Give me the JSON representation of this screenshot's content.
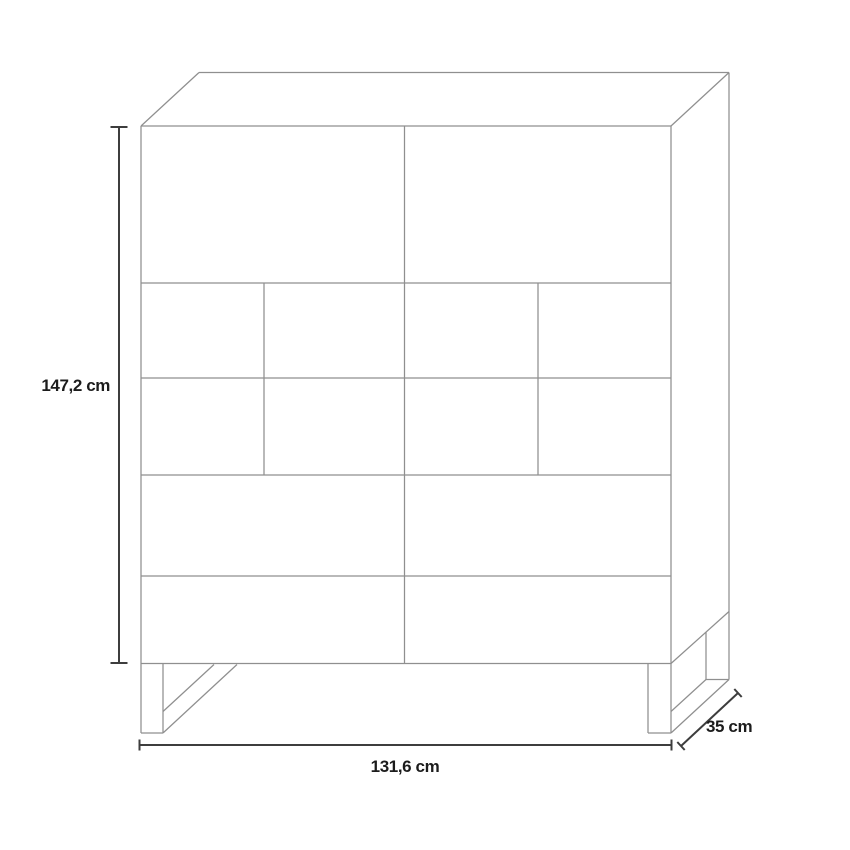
{
  "page": {
    "background": "#ffffff",
    "description": "Product dimension diagram of a tall sideboard cabinet drawn in 3D outline"
  },
  "diagram": {
    "type": "furniture-dimension-diagram",
    "unit": "cm",
    "colors": {
      "structure_stroke": "#8f8f8f",
      "dimension_stroke": "#3d3d3d",
      "label_color": "#1c1c1c"
    },
    "dimensions": {
      "height": {
        "value": 147.2,
        "label": "147,2 cm"
      },
      "width": {
        "value": 131.6,
        "label": "131,6 cm"
      },
      "depth": {
        "value": 35,
        "label": "35 cm"
      }
    },
    "front_layout": {
      "rows": [
        {
          "name": "top-doors",
          "cells": 2
        },
        {
          "name": "panel-row-1",
          "cells": 4
        },
        {
          "name": "panel-row-2",
          "cells": 4
        },
        {
          "name": "wide-drawer-1",
          "cells": 2
        },
        {
          "name": "wide-drawer-2",
          "cells": 2
        }
      ],
      "legs": 2,
      "leg_style": "sled-runner"
    },
    "segments": [
      {
        "k": "s",
        "x1": 141,
        "y1": 126,
        "x2": 141,
        "y2": 663.5
      },
      {
        "k": "s",
        "x1": 671,
        "y1": 126,
        "x2": 671,
        "y2": 663.5
      },
      {
        "k": "s",
        "x1": 141,
        "y1": 126,
        "x2": 671,
        "y2": 126
      },
      {
        "k": "s",
        "x1": 141,
        "y1": 663.5,
        "x2": 671,
        "y2": 663.5
      },
      {
        "k": "s",
        "x1": 141,
        "y1": 283,
        "x2": 671,
        "y2": 283
      },
      {
        "k": "s",
        "x1": 141,
        "y1": 378,
        "x2": 671,
        "y2": 378
      },
      {
        "k": "s",
        "x1": 141,
        "y1": 475,
        "x2": 671,
        "y2": 475
      },
      {
        "k": "s",
        "x1": 141,
        "y1": 576,
        "x2": 671,
        "y2": 576
      },
      {
        "k": "s",
        "x1": 404.5,
        "y1": 126,
        "x2": 404.5,
        "y2": 663.5
      },
      {
        "k": "s",
        "x1": 264,
        "y1": 283,
        "x2": 264,
        "y2": 475
      },
      {
        "k": "s",
        "x1": 538,
        "y1": 283,
        "x2": 538,
        "y2": 475
      },
      {
        "k": "s",
        "x1": 141,
        "y1": 126,
        "x2": 199,
        "y2": 72.5
      },
      {
        "k": "s",
        "x1": 199,
        "y1": 72.5,
        "x2": 729,
        "y2": 72.5
      },
      {
        "k": "s",
        "x1": 671,
        "y1": 126,
        "x2": 729,
        "y2": 72.5
      },
      {
        "k": "s",
        "x1": 729,
        "y1": 72.5,
        "x2": 729,
        "y2": 679.5
      },
      {
        "k": "s",
        "x1": 671,
        "y1": 663.5,
        "x2": 729,
        "y2": 611.5
      },
      {
        "k": "s",
        "x1": 141,
        "y1": 663.5,
        "x2": 141,
        "y2": 733
      },
      {
        "k": "s",
        "x1": 163,
        "y1": 663.5,
        "x2": 163,
        "y2": 733
      },
      {
        "k": "s",
        "x1": 141,
        "y1": 733,
        "x2": 163,
        "y2": 733
      },
      {
        "k": "s",
        "x1": 163,
        "y1": 711.5,
        "x2": 214,
        "y2": 664.5
      },
      {
        "k": "s",
        "x1": 163,
        "y1": 733,
        "x2": 237,
        "y2": 664.5
      },
      {
        "k": "s",
        "x1": 648,
        "y1": 663.5,
        "x2": 648,
        "y2": 733
      },
      {
        "k": "s",
        "x1": 671,
        "y1": 663.5,
        "x2": 671,
        "y2": 733
      },
      {
        "k": "s",
        "x1": 648,
        "y1": 733,
        "x2": 671,
        "y2": 733
      },
      {
        "k": "s",
        "x1": 671,
        "y1": 711.5,
        "x2": 706,
        "y2": 679.5
      },
      {
        "k": "s",
        "x1": 706,
        "y1": 632,
        "x2": 706,
        "y2": 679.5
      },
      {
        "k": "s",
        "x1": 706,
        "y1": 679.5,
        "x2": 729,
        "y2": 679.5
      },
      {
        "k": "s",
        "x1": 671,
        "y1": 733,
        "x2": 729,
        "y2": 679.5
      },
      {
        "k": "d",
        "x1": 119,
        "y1": 127,
        "x2": 119,
        "y2": 663
      },
      {
        "k": "d",
        "x1": 110.5,
        "y1": 127,
        "x2": 127.5,
        "y2": 127
      },
      {
        "k": "d",
        "x1": 110.5,
        "y1": 663,
        "x2": 127.5,
        "y2": 663
      },
      {
        "k": "d",
        "x1": 139.5,
        "y1": 745,
        "x2": 671.5,
        "y2": 745
      },
      {
        "k": "d",
        "x1": 139.5,
        "y1": 739.5,
        "x2": 139.5,
        "y2": 750.5
      },
      {
        "k": "d",
        "x1": 671.5,
        "y1": 739.5,
        "x2": 671.5,
        "y2": 750.5
      },
      {
        "k": "d",
        "x1": 681,
        "y1": 746,
        "x2": 738,
        "y2": 693
      },
      {
        "k": "d",
        "x1": 677.3,
        "y1": 742,
        "x2": 684.7,
        "y2": 750
      },
      {
        "k": "d",
        "x1": 734.3,
        "y1": 689,
        "x2": 741.7,
        "y2": 697
      }
    ]
  }
}
